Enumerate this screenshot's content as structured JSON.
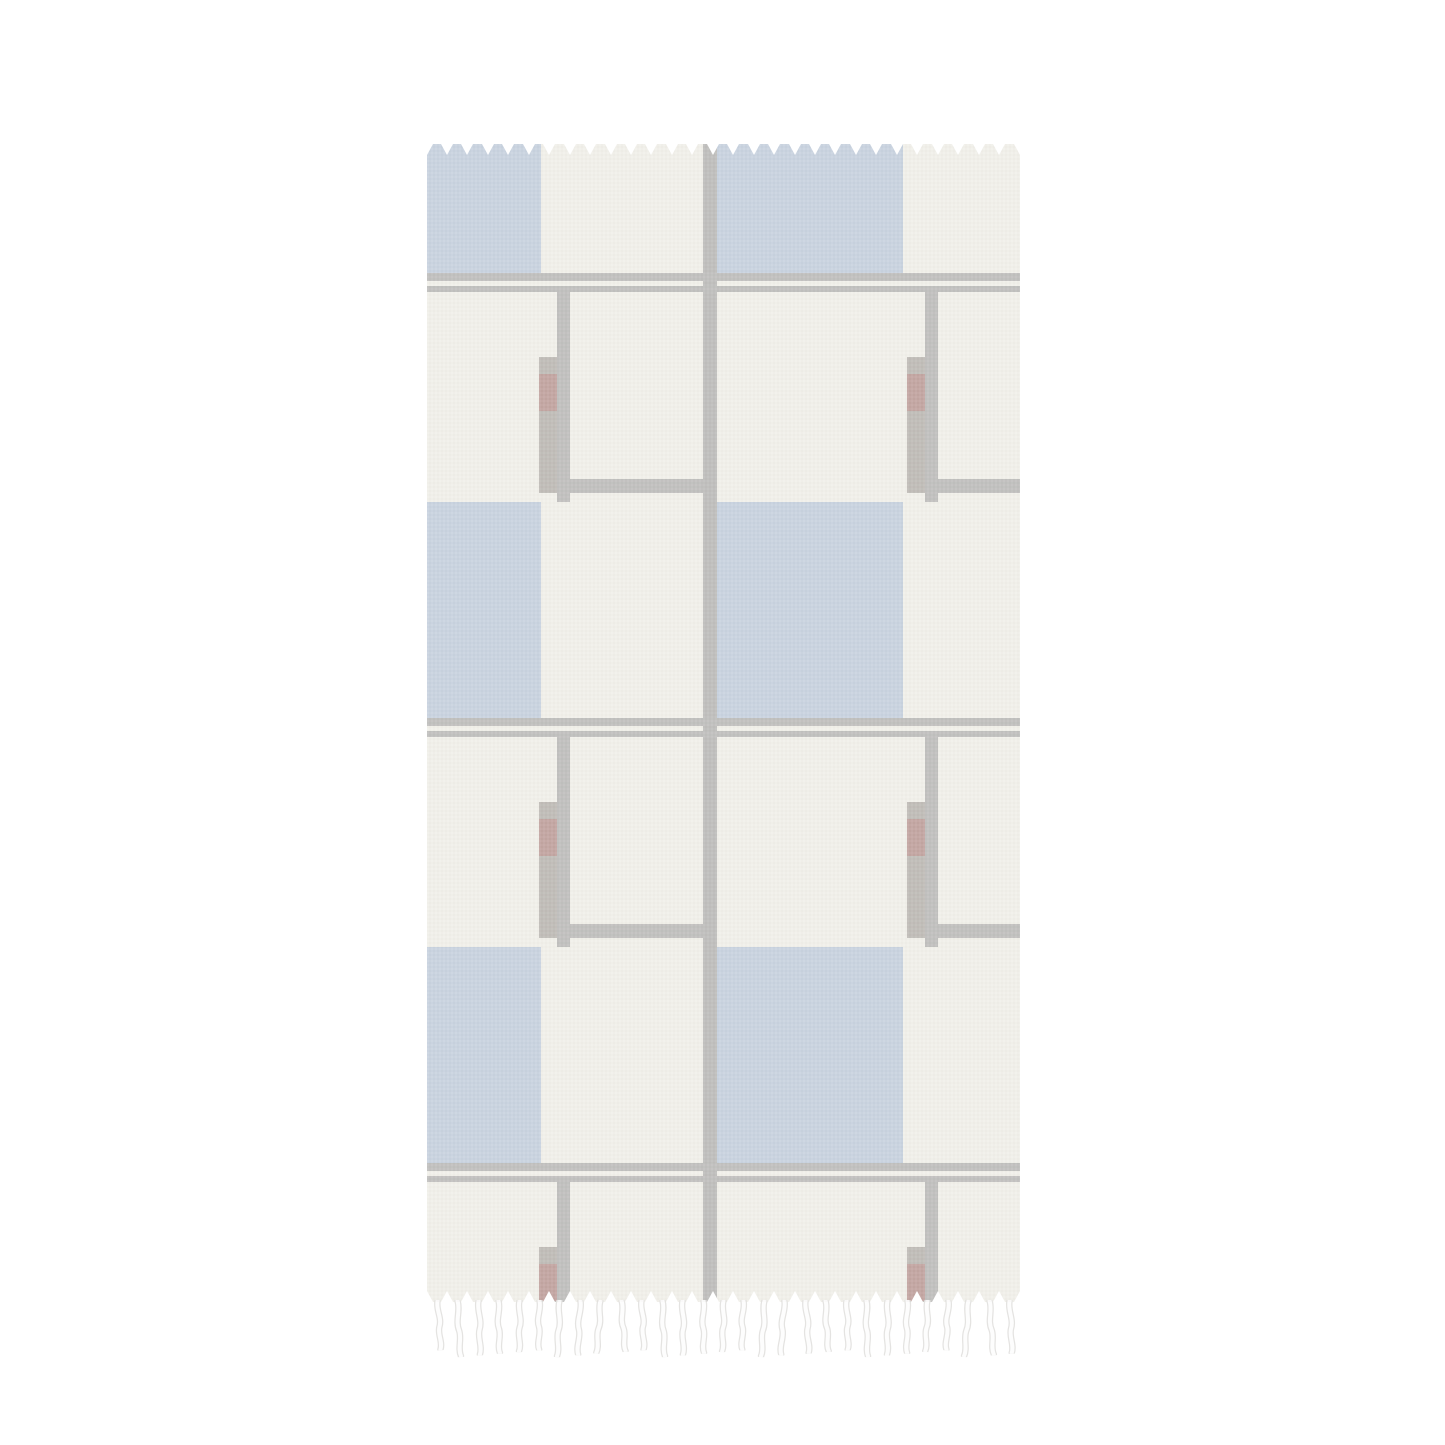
{
  "scene": {
    "background": "#ffffff",
    "description": "Product mockup photo: boho beach towel with tasseled fringe and a pale De Stijl / Mondrian style geometric print"
  },
  "towel": {
    "fabric_color": "#f1f0ea",
    "pattern_colors": {
      "blue_square": "#c9d3e0",
      "grid_line": "#c1c0be",
      "divider_line": "#bfbebc",
      "hook_bar_gray": "#c0bcb7",
      "accent_red": "#c3a5a1"
    },
    "fringe": {
      "strand_count_top": 29,
      "strand_count_bottom": 29,
      "strand_fill": "#fdfdfd",
      "strand_edge": "#e2e1df"
    }
  }
}
